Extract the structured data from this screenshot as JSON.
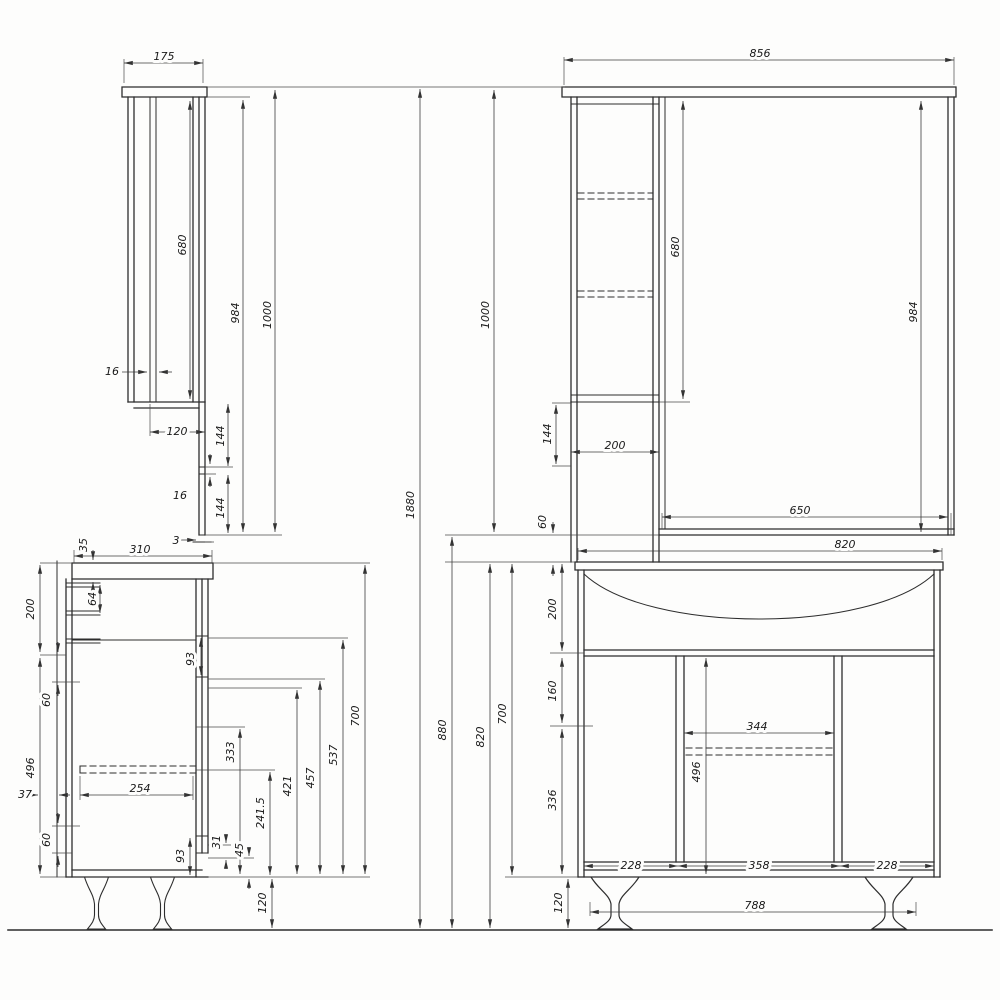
{
  "drawing": {
    "units": "mm",
    "description": "Bathroom vanity and mirror cabinet dimension drawing, four orthographic views",
    "overall": {
      "h1880": "1880"
    },
    "mirror_side": {
      "w175": "175",
      "h680": "680",
      "h984": "984",
      "h1000": "1000",
      "t16_wall": "16",
      "w120": "120",
      "h144_upper": "144",
      "t16_rail": "16",
      "h144_lower": "144",
      "t3": "3"
    },
    "mirror_front": {
      "w856": "856",
      "h680": "680",
      "h984": "984",
      "h1000": "1000",
      "h144": "144",
      "w200": "200",
      "gap60": "60",
      "w650": "650"
    },
    "vanity_side": {
      "t35": "35",
      "d310": "310",
      "s64": "64",
      "h200": "200",
      "s60_upper": "60",
      "h496": "496",
      "d37": "37",
      "d254": "254",
      "s60_lower": "60",
      "h93_upper": "93",
      "h333": "333",
      "h421": "421",
      "h457": "457",
      "h537": "537",
      "h700": "700",
      "h93_lower": "93",
      "h31": "31",
      "h45": "45",
      "h241_5": "241.5",
      "leg_h120": "120"
    },
    "vanity_front": {
      "w820_top": "820",
      "h880": "880",
      "h820": "820",
      "h700": "700",
      "h200": "200",
      "h160": "160",
      "h336": "336",
      "w344": "344",
      "h496": "496",
      "w228_left": "228",
      "w358": "358",
      "w228_right": "228",
      "w788": "788",
      "leg_h120": "120"
    }
  }
}
